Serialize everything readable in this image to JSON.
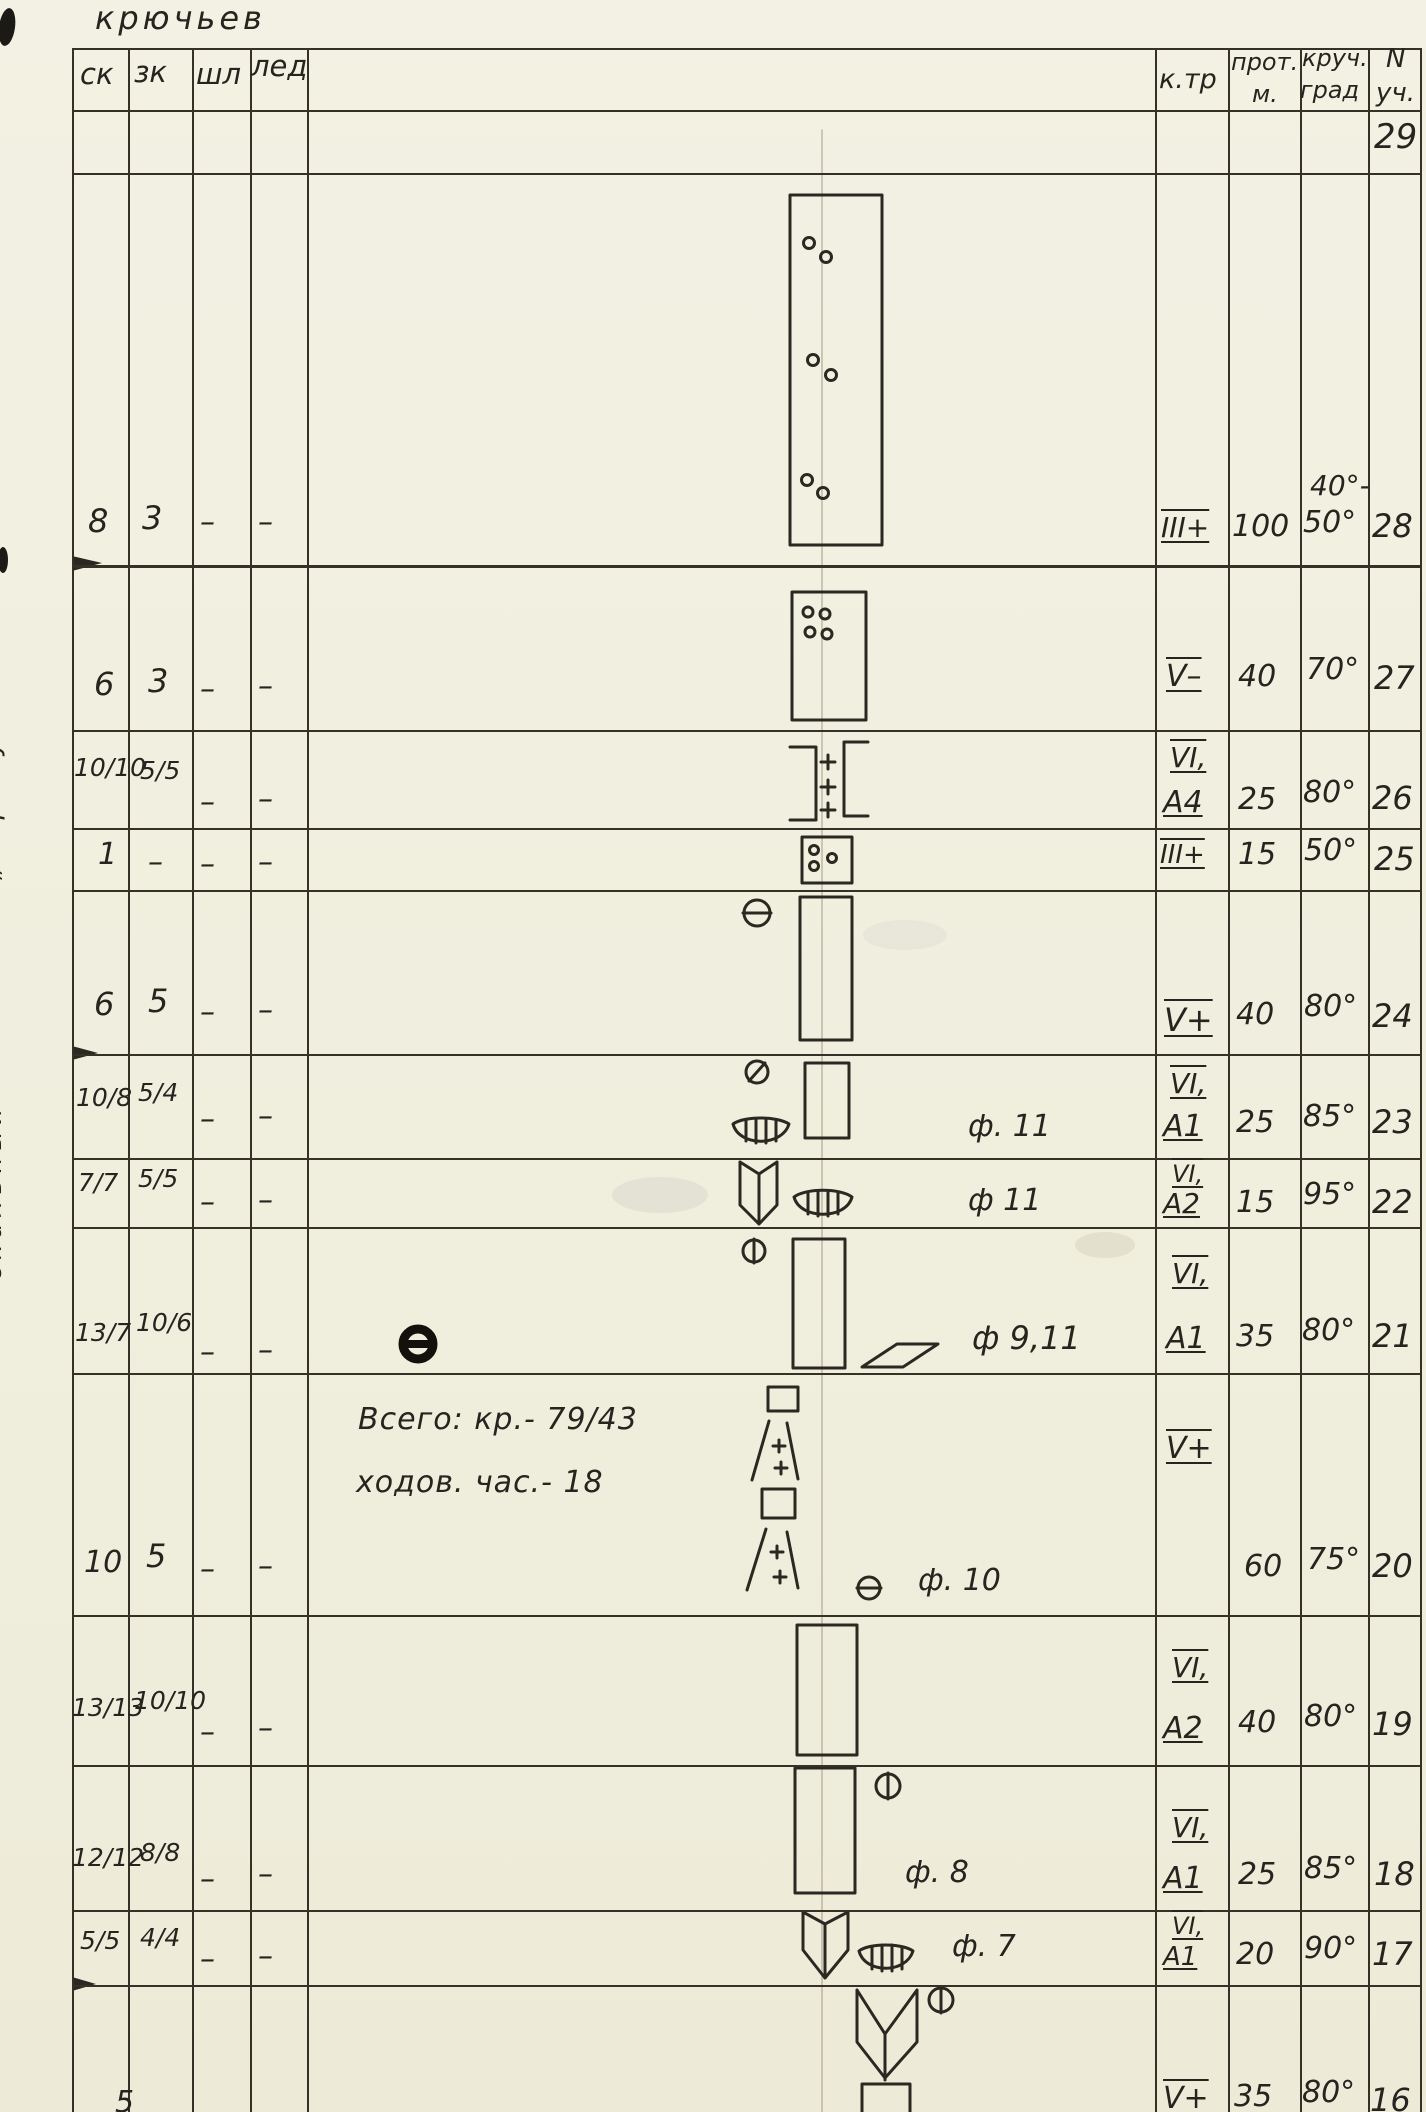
{
  "document": {
    "corner_note": "крючьев",
    "totals_line1": "Всего: кр.- 79/43",
    "totals_line2": "ходов. час.- 18"
  },
  "header": {
    "sk": "ск",
    "zk": "зк",
    "shl": "шл",
    "led": "лед",
    "ktr": "к.тр",
    "prot_top": "прот.",
    "prot_bot": "м.",
    "krut_top": "круч.",
    "krut_bot": "град",
    "n_top": "N",
    "n_bot": "уч."
  },
  "margin": {
    "labels": [
      "„Треугольник“",
      "скальный",
      "пояс",
      "скальный",
      "Второй"
    ]
  },
  "rows": {
    "r29": {
      "n": "29"
    },
    "r28": {
      "sk": "8",
      "zk": "3",
      "shl": "–",
      "led": "–",
      "ktr": "III+",
      "prot": "100",
      "krut_a": "40°-",
      "krut_b": "50°",
      "n": "28"
    },
    "r27": {
      "sk": "6",
      "zk": "3",
      "shl": "–",
      "led": "–",
      "ktr": "V–",
      "prot": "40",
      "krut": "70°",
      "n": "27"
    },
    "r26": {
      "sk": "10/10",
      "zk": "5/5",
      "shl": "–",
      "led": "–",
      "ktr": "VI,",
      "aid": "А4",
      "prot": "25",
      "krut": "80°",
      "n": "26"
    },
    "r25": {
      "sk": "1",
      "zk": "–",
      "shl": "–",
      "led": "–",
      "ktr": "III+",
      "prot": "15",
      "krut": "50°",
      "n": "25"
    },
    "r24": {
      "sk": "6",
      "zk": "5",
      "shl": "–",
      "led": "–",
      "ktr": "V+",
      "prot": "40",
      "krut": "80°",
      "n": "24"
    },
    "r23": {
      "sk": "10/8",
      "zk": "5/4",
      "shl": "–",
      "led": "–",
      "ktr": "VI,",
      "aid": "А1",
      "prot": "25",
      "krut": "85°",
      "n": "23",
      "photo": "ф. 11"
    },
    "r22": {
      "sk": "7/7",
      "zk": "5/5",
      "shl": "–",
      "led": "–",
      "ktr": "VI,",
      "aid": "А2",
      "prot": "15",
      "krut": "95°",
      "n": "22",
      "photo": "ф 11"
    },
    "r21": {
      "sk": "13/7",
      "zk": "10/6",
      "shl": "–",
      "led": "–",
      "ktr": "VI,",
      "aid": "А1",
      "prot": "35",
      "krut": "80°",
      "n": "21",
      "photo": "ф 9,11"
    },
    "r20": {
      "sk": "10",
      "zk": "5",
      "shl": "–",
      "led": "–",
      "ktr": "V+",
      "prot": "60",
      "krut": "75°",
      "n": "20",
      "photo": "ф. 10"
    },
    "r19": {
      "sk": "13/13",
      "zk": "10/10",
      "shl": "–",
      "led": "–",
      "ktr": "VI,",
      "aid": "А2",
      "prot": "40",
      "krut": "80°",
      "n": "19"
    },
    "r18": {
      "sk": "12/12",
      "zk": "8/8",
      "shl": "–",
      "led": "–",
      "ktr": "VI,",
      "aid": "А1",
      "prot": "25",
      "krut": "85°",
      "n": "18",
      "photo": "ф. 8"
    },
    "r17": {
      "sk": "5/5",
      "zk": "4/4",
      "shl": "–",
      "led": "–",
      "ktr": "VI,",
      "aid": "А1",
      "prot": "20",
      "krut": "90°",
      "n": "17",
      "photo": "ф. 7"
    },
    "r16": {
      "sk": "5",
      "ktr": "V+",
      "prot": "35",
      "krut": "80°",
      "n": "16"
    }
  }
}
